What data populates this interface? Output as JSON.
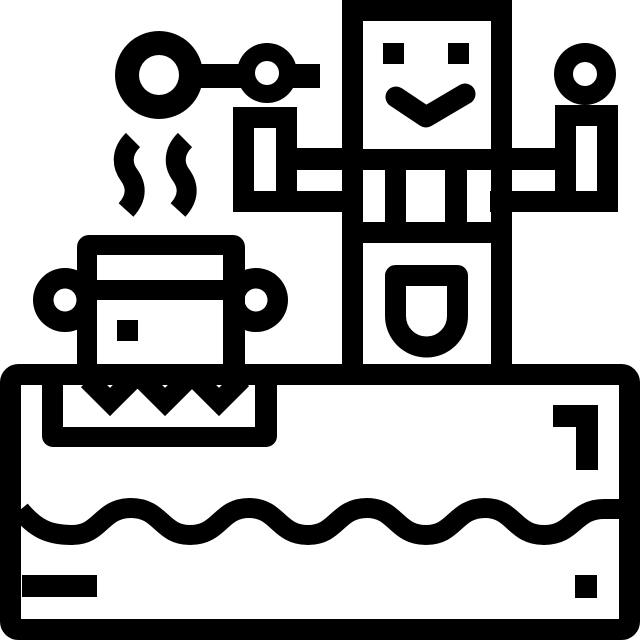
{
  "canvas": {
    "width": 640,
    "height": 640
  },
  "colors": {
    "ink": "#000000",
    "background": "#ffffff"
  },
  "illustration": {
    "name": "robot-chef-cooking-icon",
    "description": "Black outline pictogram of a smiling robot with raised arms holding a ladle spoon, next to a steaming cooking pot sitting on a counter stove with a water wave pattern",
    "parts": [
      "robot-figure",
      "robot-head",
      "robot-eyes",
      "robot-smile",
      "robot-torso",
      "robot-pocket",
      "left-arm",
      "right-arm",
      "ladle-spoon",
      "steam-squiggles",
      "cooking-pot",
      "pot-handles",
      "burner-tray",
      "heat-marks",
      "counter-frame",
      "water-wave",
      "corner-hook-mark",
      "dash-mark",
      "square-dot-mark"
    ]
  }
}
